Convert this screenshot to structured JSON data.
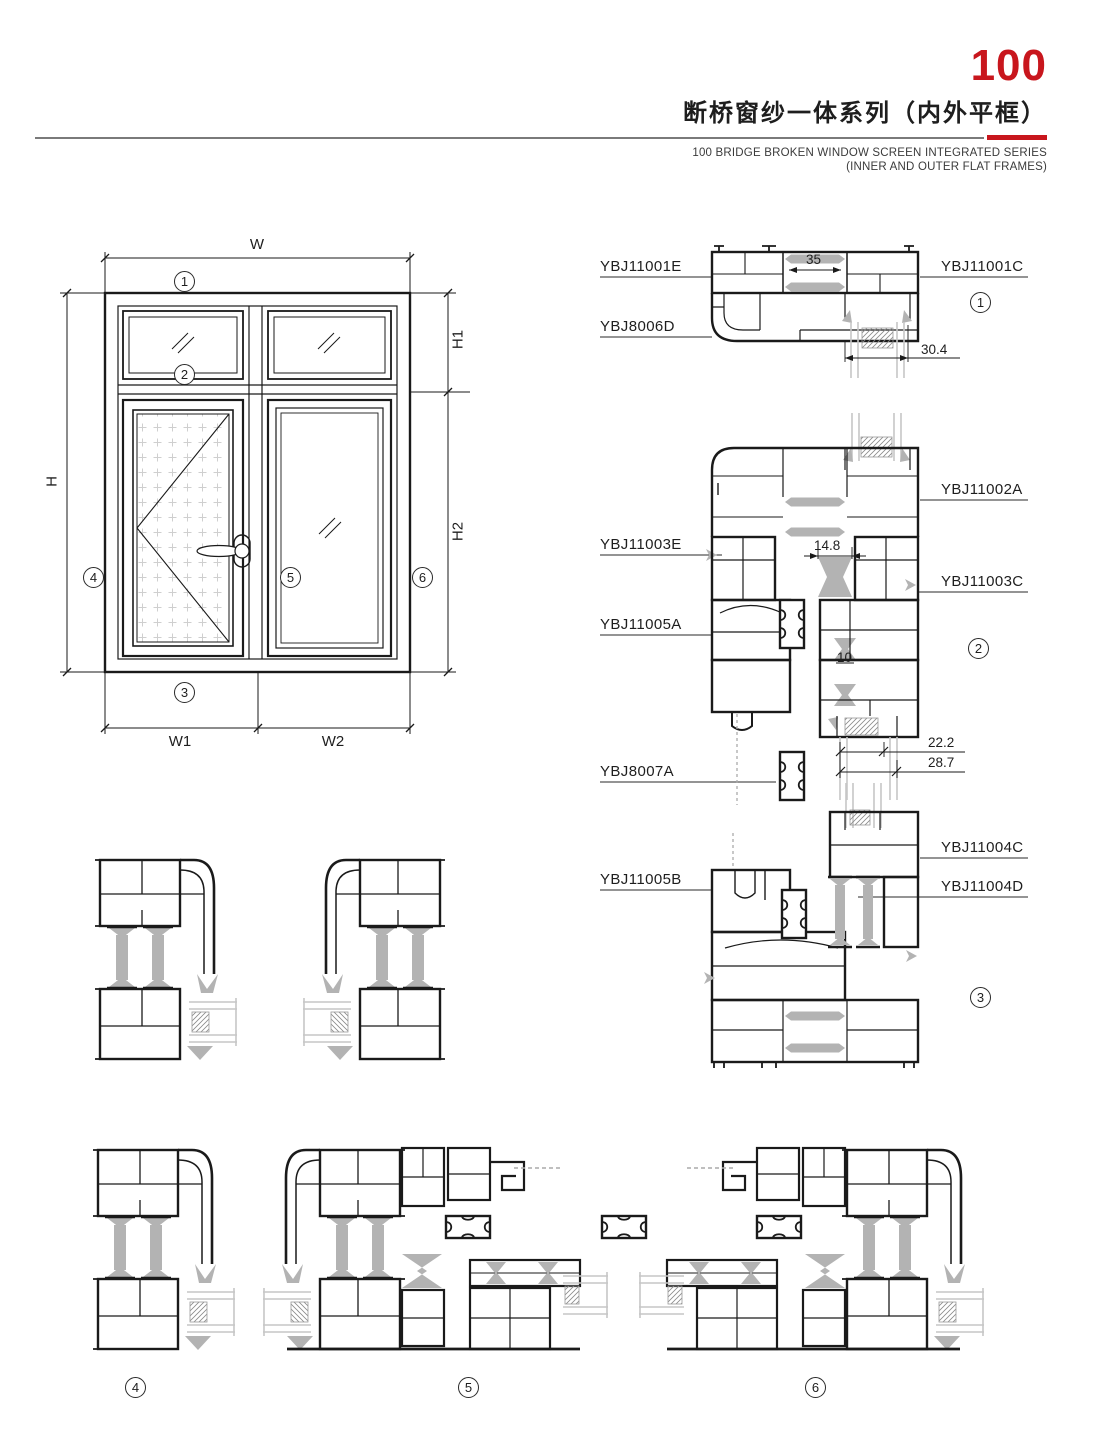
{
  "header": {
    "series_number": "100",
    "title_cn": "断桥窗纱一体系列（内外平框）",
    "subtitle_en_line1": "100 BRIDGE BROKEN WINDOW SCREEN INTEGRATED SERIES",
    "subtitle_en_line2": "(INNER AND OUTER FLAT FRAMES)",
    "accent_color": "#c8161d"
  },
  "elevation": {
    "dim_w": "W",
    "dim_w1": "W1",
    "dim_w2": "W2",
    "dim_h": "H",
    "dim_h1": "H1",
    "dim_h2": "H2",
    "marker_1": "1",
    "marker_2": "2",
    "marker_3": "3",
    "marker_4": "4",
    "marker_5": "5",
    "marker_6": "6"
  },
  "details": {
    "marker_1": "1",
    "marker_2": "2",
    "marker_3": "3",
    "marker_4": "4",
    "marker_5": "5",
    "marker_6": "6",
    "labels": {
      "ybj11001e": "YBJ11001E",
      "ybj11001c": "YBJ11001C",
      "ybj8006d": "YBJ8006D",
      "ybj11002a": "YBJ11002A",
      "ybj11003e": "YBJ11003E",
      "ybj11003c": "YBJ11003C",
      "ybj11005a": "YBJ11005A",
      "ybj8007a": "YBJ8007A",
      "ybj11005b": "YBJ11005B",
      "ybj11004c": "YBJ11004C",
      "ybj11004d": "YBJ11004D"
    },
    "dims": {
      "d35": "35",
      "d30_4": "30.4",
      "d14_8": "14.8",
      "d10": "10",
      "d22_2": "22.2",
      "d28_7": "28.7"
    }
  }
}
